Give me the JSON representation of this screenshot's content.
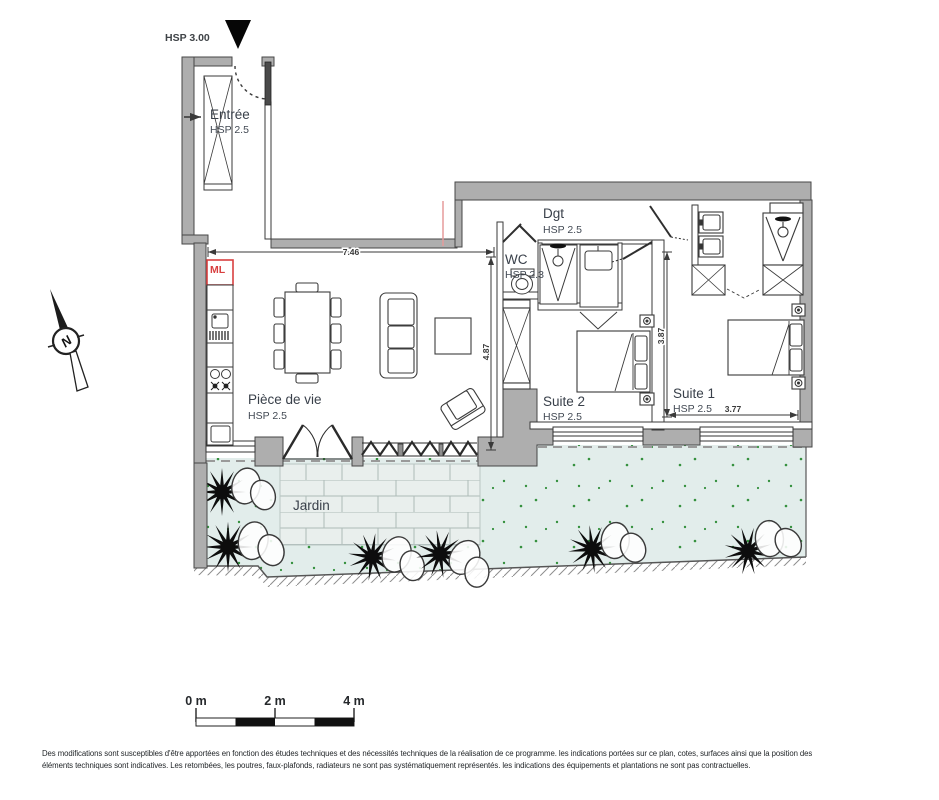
{
  "plan": {
    "ceiling_marker": "HSP 3.00",
    "rooms": {
      "entree": {
        "name": "Entrée",
        "hsp": "HSP 2.5"
      },
      "dgt": {
        "name": "Dgt",
        "hsp": "HSP 2.5"
      },
      "wc": {
        "name": "WC",
        "hsp": "HSP 2.3"
      },
      "piece_de_vie": {
        "name": "Pièce de vie",
        "hsp": "HSP 2.5"
      },
      "suite2": {
        "name": "Suite 2",
        "hsp": "HSP 2.5"
      },
      "suite1": {
        "name": "Suite 1",
        "hsp": "HSP 2.5"
      },
      "jardin": {
        "name": "Jardin"
      }
    },
    "appliances": {
      "washing_machine": "ML"
    },
    "dimensions": {
      "living_width_m": "7.46",
      "living_depth_m": "4.87",
      "suites_depth_m": "3.87",
      "suite1_width_m": "3.77"
    },
    "compass_north": "N"
  },
  "scale_bar": {
    "labels": [
      "0 m",
      "2 m",
      "4 m"
    ]
  },
  "footer": {
    "line1": "Des modifications sont susceptibles d'être apportées en fonction des études techniques et des nécessités techniques de la réalisation de ce programme. les indications portées sur ce plan, cotes, surfaces ainsi que la position des",
    "line2": "éléments techniques sont indicatives. Les retombées, les poutres, faux-plafonds, radiateurs ne sont pas systématiquement représentés. les indications des équipements et plantations ne sont pas contractuelles."
  },
  "colors": {
    "wall_gray": "#aeaeae",
    "garden_green": "#e2edeb",
    "terrace": "#e9efed",
    "accent_red": "#d84040",
    "line": "#3c3c3c",
    "dot_green": "#35913e"
  }
}
